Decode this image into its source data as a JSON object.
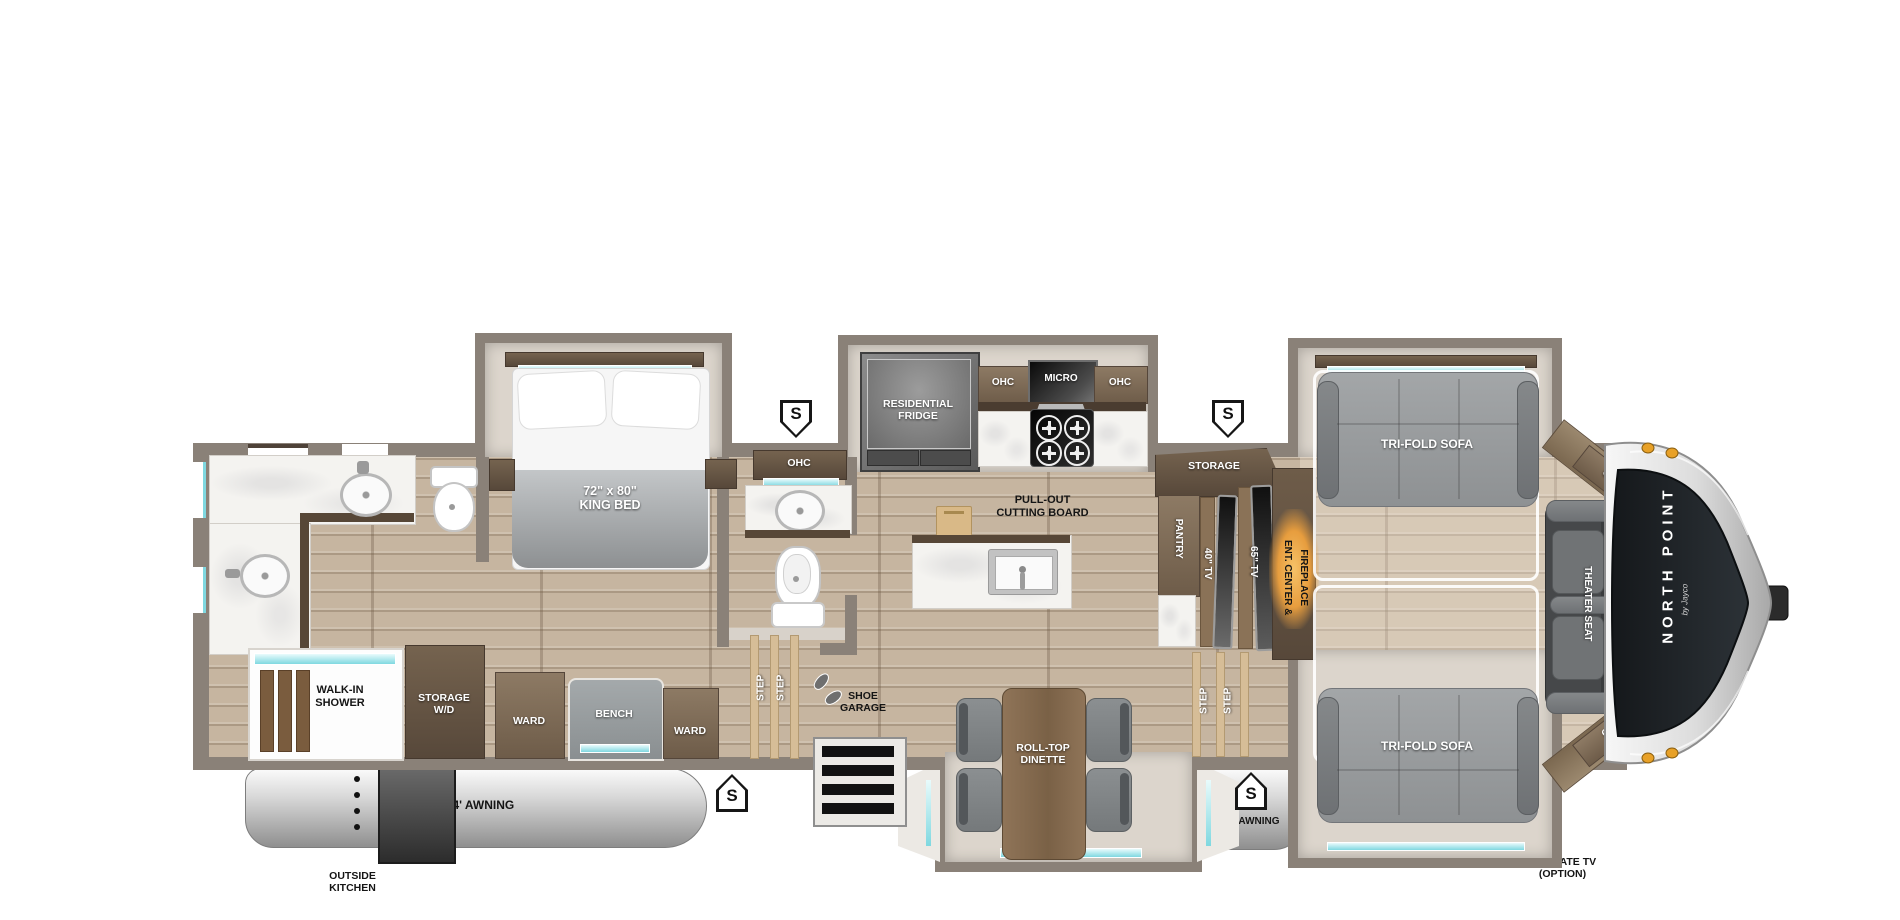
{
  "colors": {
    "wall": "#8a8178",
    "floor_wood": "#c6b5a0",
    "teal_accent": "#7fd8e0",
    "fireplace_glow": "#eba243",
    "cap_dark": "#1e2226",
    "marker_amber": "#e8a128",
    "awning_silver": "#c9c9c9"
  },
  "markers": {
    "s": "S"
  },
  "rear_bath": {
    "shower_line1": "WALK-IN",
    "shower_line2": "SHOWER",
    "storage_wd_line1": "STORAGE",
    "storage_wd_line2": "W/D"
  },
  "bedroom": {
    "bed_line1": "72\" x 80\"",
    "bed_line2": "KING BED",
    "ward_left": "WARD",
    "bench": "BENCH",
    "ward_right": "WARD"
  },
  "mid_bath": {
    "ohc": "OHC"
  },
  "entry": {
    "step": "STEP",
    "shoe_line1": "SHOE",
    "shoe_line2": "GARAGE"
  },
  "kitchen": {
    "fridge_line1": "RESIDENTIAL",
    "fridge_line2": "FRIDGE",
    "ohc_left": "OHC",
    "micro": "MICRO",
    "ohc_right": "OHC",
    "island_line1": "PULL-OUT",
    "island_line2": "CUTTING BOARD"
  },
  "dinette": {
    "line1": "ROLL-TOP",
    "line2": "DINETTE"
  },
  "media_wall": {
    "storage": "STORAGE",
    "pantry": "PANTRY",
    "tv_40": "40\" TV",
    "tv_65": "65\" TV",
    "ent_line1": "ENT. CENTER &",
    "ent_line2": "FIREPLACE",
    "step": "STEP"
  },
  "living": {
    "sofa_top": "TRI-FOLD SOFA",
    "sofa_bottom": "TRI-FOLD SOFA",
    "theater_seat": "THEATER SEAT",
    "ohc_front_top": "OHC",
    "ohc_front_bottom": "OHC"
  },
  "front_cap": {
    "brand": "NORTH POINT",
    "brand_by": "by Jayco"
  },
  "exterior": {
    "awning_rear": "14' AWNING",
    "awning_front": "14' AWNING",
    "outside_kitchen_line1": "OUTSIDE",
    "outside_kitchen_line2": "KITCHEN",
    "tailgate_line1": "TAILGATE TV",
    "tailgate_line2": "(OPTION)"
  }
}
